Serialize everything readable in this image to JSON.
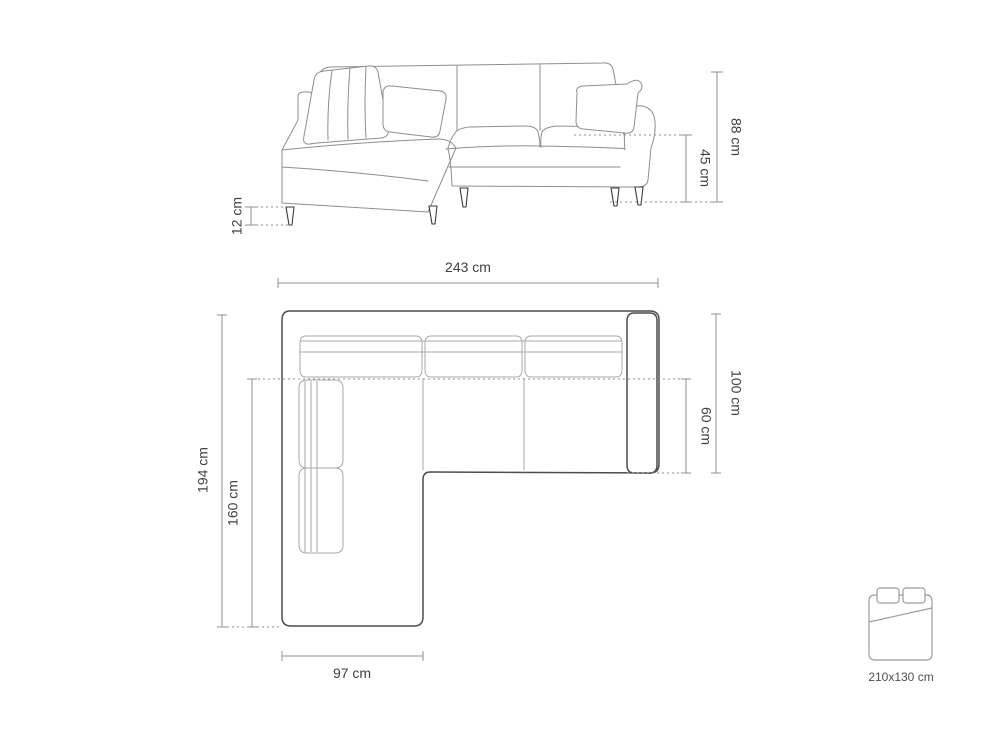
{
  "dimensions": {
    "front": {
      "height": "88 cm",
      "seat_height": "45 cm",
      "leg_height": "12 cm"
    },
    "plan": {
      "width": "243 cm",
      "depth": "194 cm",
      "chaise_length": "160 cm",
      "body_depth": "100 cm",
      "seat_depth": "60 cm",
      "chaise_width": "97 cm"
    },
    "bed": {
      "label": "210x130 cm"
    }
  },
  "colors": {
    "background": "#ffffff",
    "sketch_line": "#8e8e8e",
    "outline_dark": "#4d4d4d",
    "detail_line": "#a9a9a9",
    "dimension_line": "#8f8f8f",
    "text": "#3c4247",
    "leg": "#3a3a3a"
  }
}
